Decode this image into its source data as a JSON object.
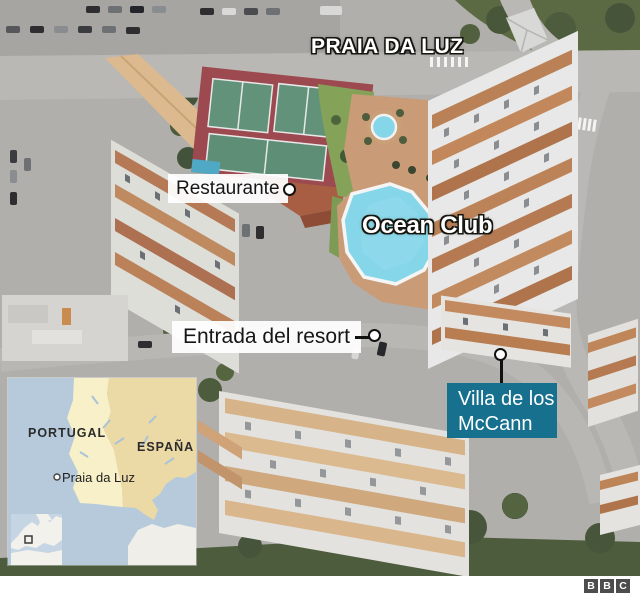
{
  "theme": {
    "accent_teal": "#17718e",
    "pool_blue": "#85d6e8",
    "label_text": "#161616",
    "overlay_text": "#ffffff",
    "inset_sea": "#b6cadb",
    "inset_portugal": "#f8f0c8",
    "inset_spain": "#ebd9a6",
    "bbc_gray": "#4d4d4d"
  },
  "photo": {
    "town_title": "PRAIA DA LUZ",
    "resort_name": "Ocean Club",
    "restaurant_label": "Restaurante",
    "entrance_label": "Entrada del resort",
    "villa_label_line1": "Villa de los",
    "villa_label_line2": "McCann"
  },
  "inset": {
    "country1": "PORTUGAL",
    "country2": "ESPAÑA",
    "town": "Praia da Luz"
  },
  "footer": {
    "logo_letters": [
      "B",
      "B",
      "C"
    ]
  }
}
